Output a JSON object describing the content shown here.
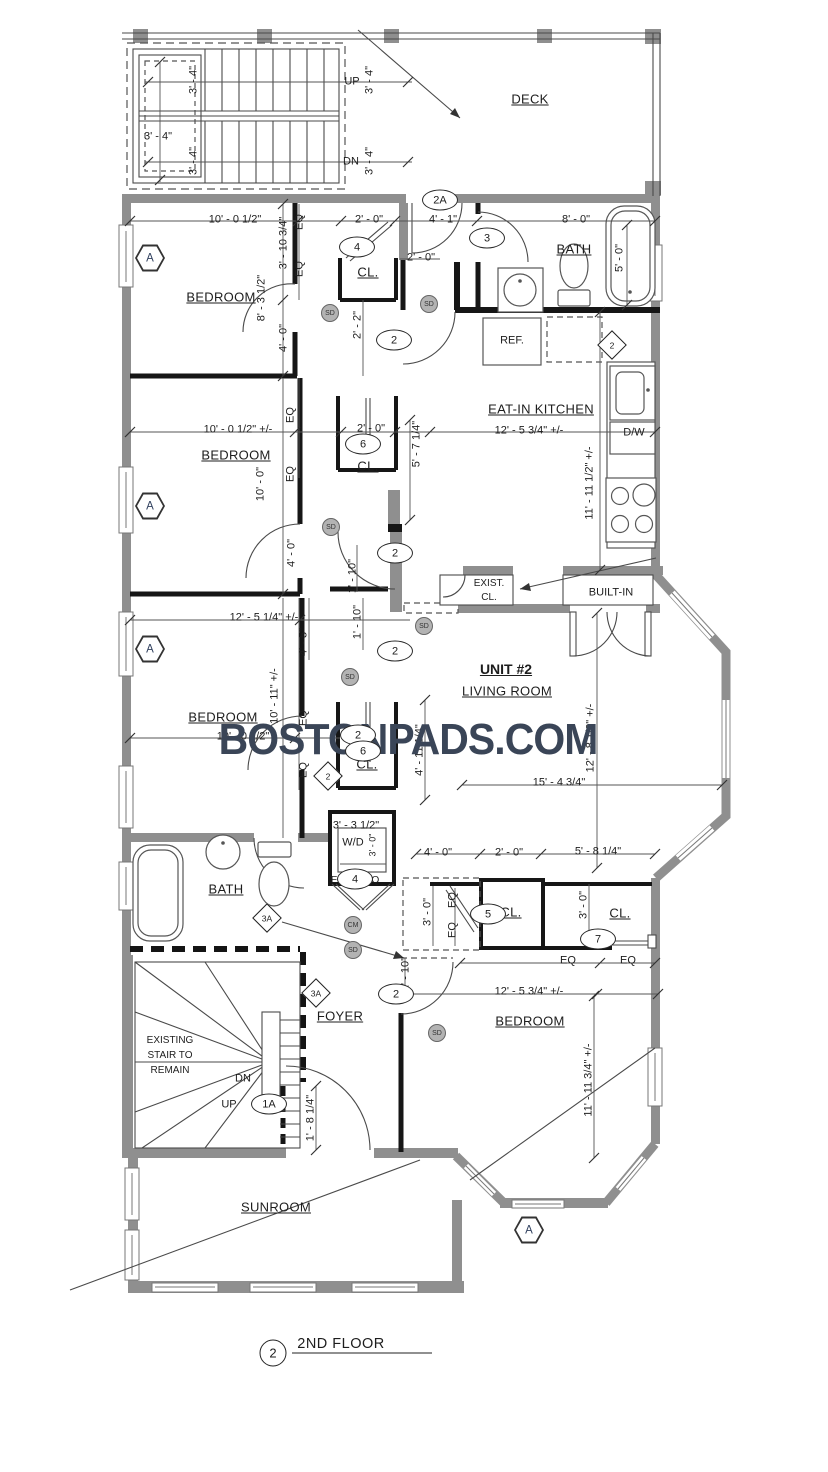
{
  "labels": {
    "deck": "DECK",
    "bedroom": "BEDROOM",
    "bath": "BATH",
    "eat_in_kitchen": "EAT-IN KITCHEN",
    "unit": "UNIT #2",
    "living_room": "LIVING ROOM",
    "sunroom": "SUNROOM",
    "foyer": "FOYER",
    "exist": "EXIST.",
    "exist_cl": "CL.",
    "built_in": "BUILT-IN",
    "ref": "REF.",
    "dw": "D/W",
    "wd": "W/D",
    "cl": "CL.",
    "up": "UP",
    "dn": "DN",
    "stair1": "EXISTING",
    "stair2": "STAIR TO",
    "stair3": "REMAIN",
    "floor_title": "2ND FLOOR",
    "floor_num": "2",
    "watermark": "BOSTONPADS.COM"
  },
  "dims": {
    "d3_4": "3' - 4\"",
    "d10_0h": "10' - 0 1/2\"",
    "d10_0hpm": "10' - 0 1/2\"  +/-",
    "d8_3h": "8' - 3 1/2\"",
    "d3_10": "3' - 10 3/4\"",
    "d4_0": "4' - 0\"",
    "d2_0": "2' - 0\"",
    "d2_2": "2' - 2\"",
    "d4_1": "4' - 1\"",
    "d8_0": "8' - 0\"",
    "d5_0": "5' - 0\"",
    "d12_5_34": "12' - 5 3/4\"  +/-",
    "d11_11_12": "11' - 11 1/2\"  +/-",
    "d5_7": "5' - 7 1/4\"",
    "d10_0": "10' - 0\"",
    "d1_10": "1' - 10\"",
    "d12_5_14": "12' - 5 1/4\"  +/-",
    "d4_5": "4' - 5\"",
    "d10_11": "10' - 11\"  +/-",
    "d4_11": "4' - 11 1/4\"",
    "d12_8": "12' - 8 1/2\"  +/-",
    "d15_4": "15' - 4 3/4\"",
    "d3_3": "3' - 3 1/2\"",
    "d3_0": "3' - 0\"",
    "d5_8": "5' - 8 1/4\"",
    "d11_11_34": "11' - 11 3/4\"  +/-",
    "d1_8": "1' - 8 1/4\"",
    "eq": "EQ"
  },
  "callouts": {
    "c2a": "2A",
    "c2": "2",
    "c3": "3",
    "c4": "4",
    "c5": "5",
    "c6": "6",
    "c7": "7",
    "c1a": "1A",
    "d2": "2",
    "d3a": "3A",
    "ha": "A",
    "sd": "SD",
    "cm": "CM"
  }
}
